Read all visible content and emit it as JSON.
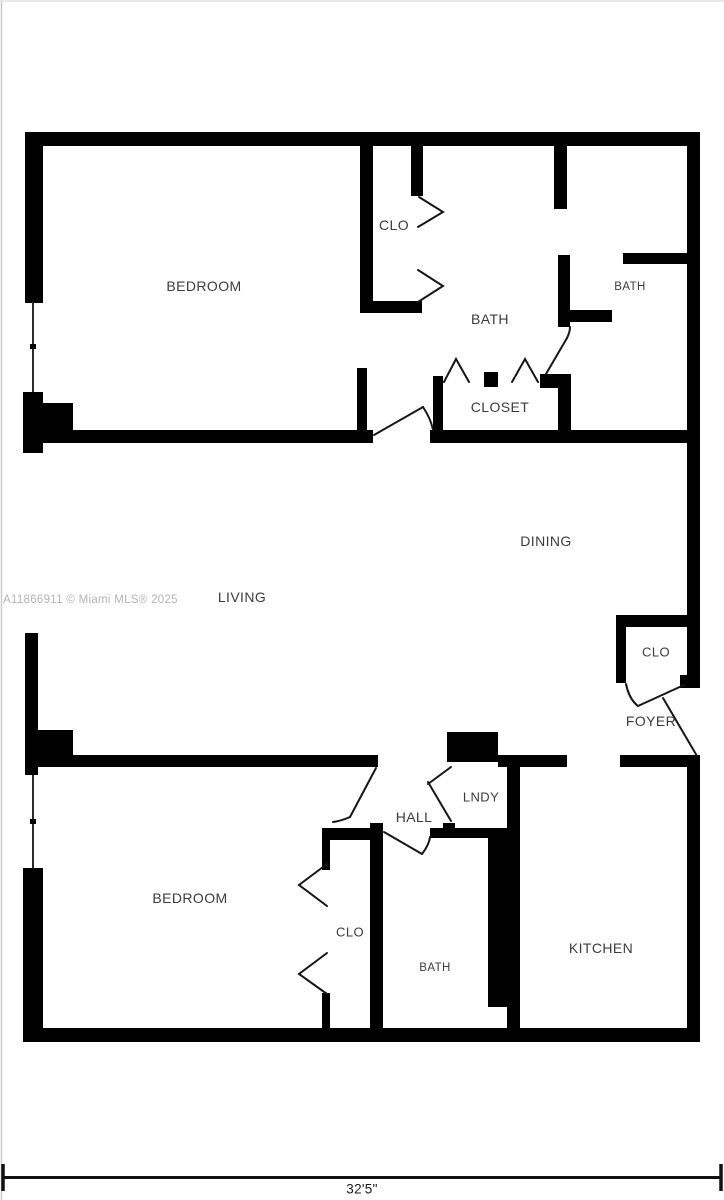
{
  "watermark": "A11866911 © Miami MLS® 2025",
  "dimension_label": "32'5\"",
  "rooms": {
    "bedroom_top": "BEDROOM",
    "closet_top": "CLO",
    "bath_main": "BATH",
    "bath_ensuite": "BATH",
    "closet_hall": "CLOSET",
    "dining": "DINING",
    "living": "LIVING",
    "closet_foyer": "CLO",
    "foyer": "FOYER",
    "laundry": "LNDY",
    "hall": "HALL",
    "bedroom_bottom": "BEDROOM",
    "closet_bottom": "CLO",
    "bath_bottom": "BATH",
    "kitchen": "KITCHEN"
  },
  "colors": {
    "wall": "#000000",
    "door_line": "#161616",
    "label_text": "#3c3c3c",
    "watermark_text": "#b5b5b5",
    "border_line": "#c9c9c9"
  }
}
